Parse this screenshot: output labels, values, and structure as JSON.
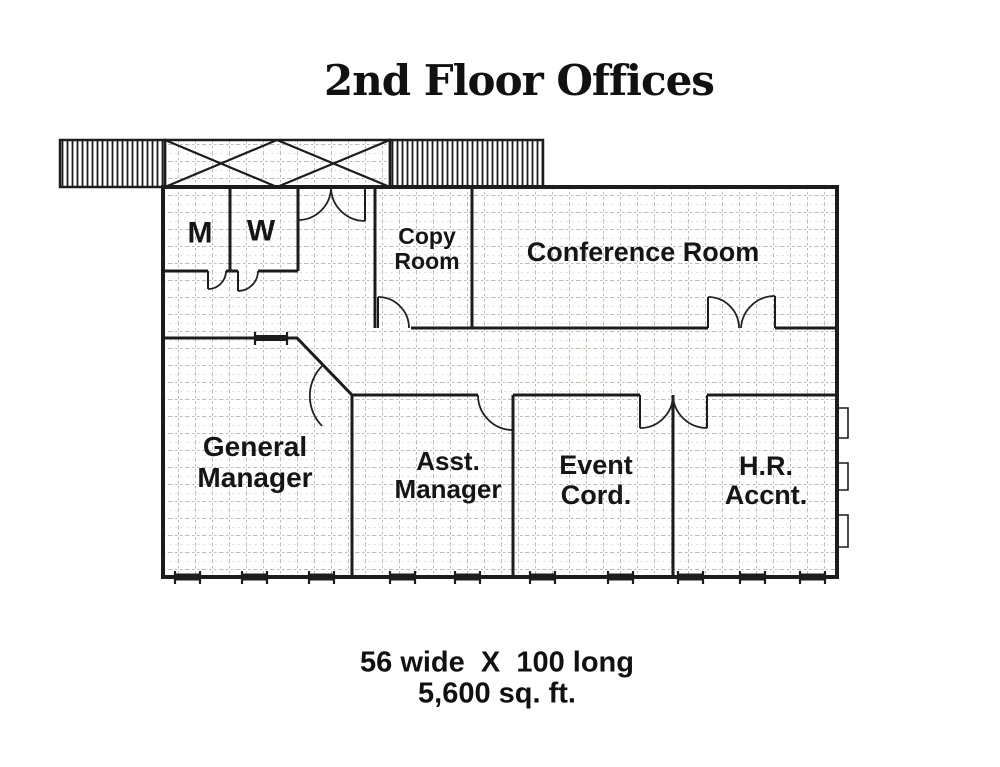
{
  "title": "2nd Floor Offices",
  "rooms": {
    "mens_restroom": {
      "label": "M"
    },
    "womens_restroom": {
      "label": "W"
    },
    "copy_room": {
      "line1": "Copy",
      "line2": "Room"
    },
    "conference_room": {
      "label": "Conference Room"
    },
    "general_manager": {
      "line1": "General",
      "line2": "Manager"
    },
    "asst_manager": {
      "line1": "Asst.",
      "line2": "Manager"
    },
    "event_coordinator": {
      "line1": "Event",
      "line2": "Cord."
    },
    "hr_accountant": {
      "line1": "H.R.",
      "line2": "Accnt."
    }
  },
  "footer": {
    "dimensions": "56 wide  X  100 long",
    "area": "5,600 sq. ft."
  },
  "colors": {
    "ink": "#1c1c1c",
    "grid_line": "#bdbcb8",
    "background": "#ffffff"
  }
}
